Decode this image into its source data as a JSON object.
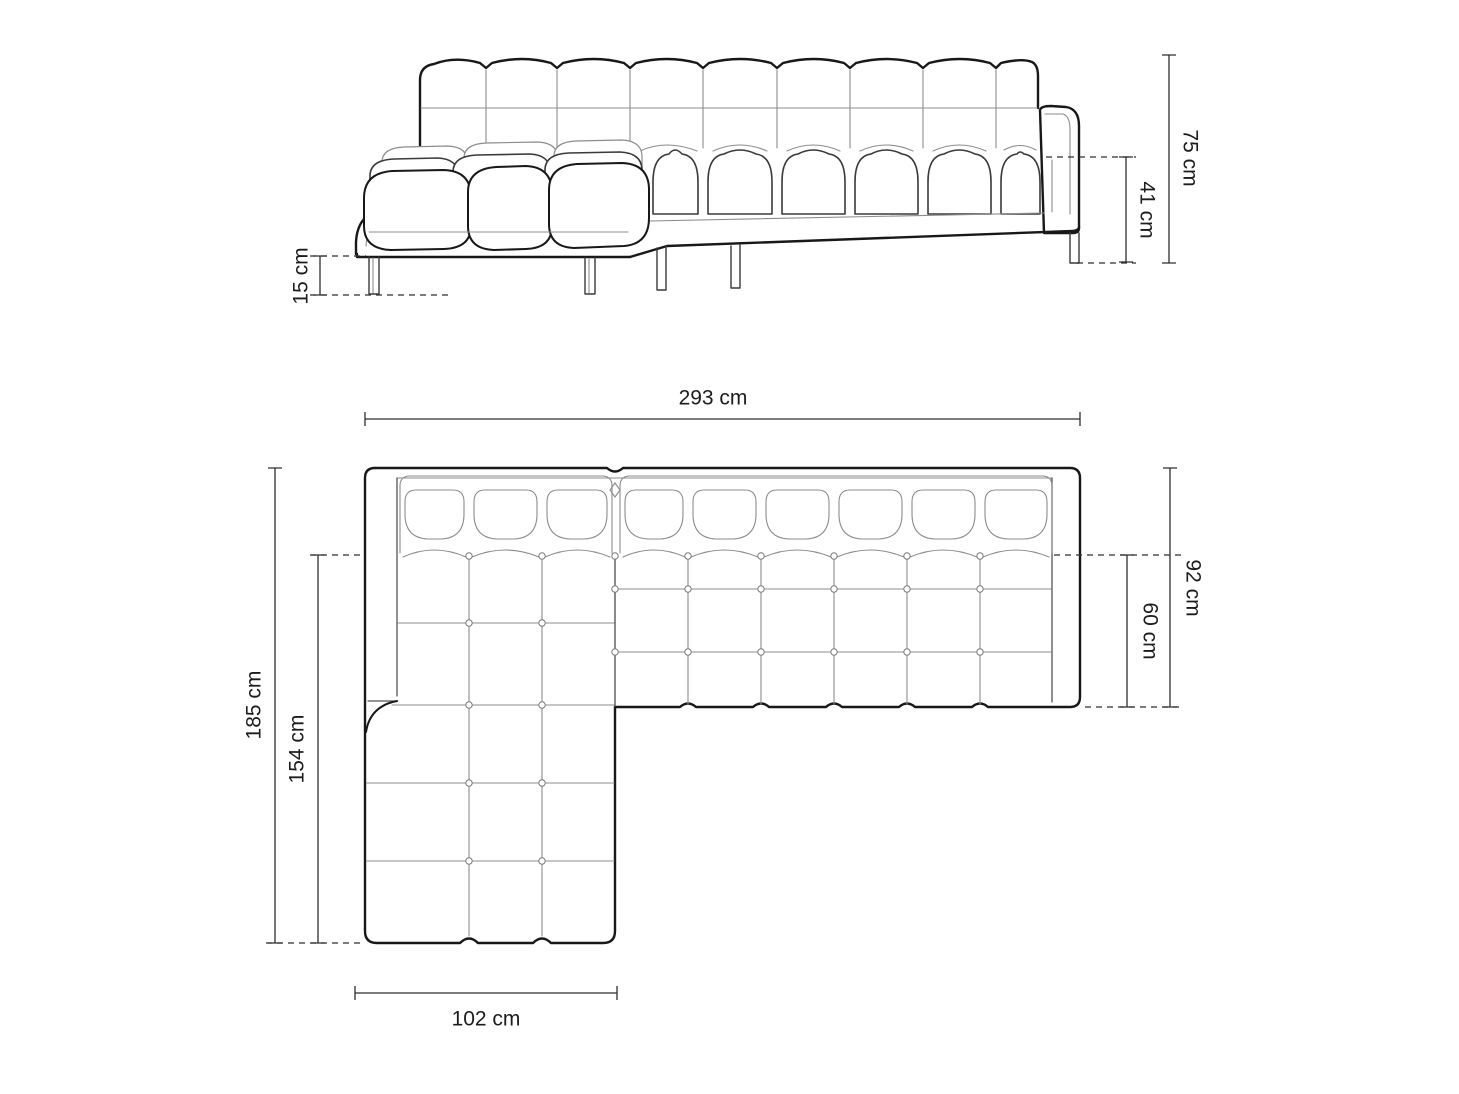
{
  "diagram": {
    "depicts": "corner sofa with left chaise longue, front elevation view and top plan view with dimension lines"
  },
  "colors": {
    "background": "#ffffff",
    "outline": "#181818",
    "seam_line": "#8c8c8c",
    "dimension_line": "#2e2e2e",
    "label_text": "#1c1c1c"
  },
  "front_view": {
    "dimensions": {
      "total_height": {
        "label": "75 cm",
        "value": 75,
        "unit": "cm"
      },
      "seat_height": {
        "label": "41 cm",
        "value": 41,
        "unit": "cm"
      },
      "leg_height": {
        "label": "15 cm",
        "value": 15,
        "unit": "cm"
      }
    }
  },
  "top_view": {
    "dimensions": {
      "total_width": {
        "label": "293 cm",
        "value": 293,
        "unit": "cm"
      },
      "total_depth": {
        "label": "185 cm",
        "value": 185,
        "unit": "cm"
      },
      "chaise_depth": {
        "label": "154 cm",
        "value": 154,
        "unit": "cm"
      },
      "body_depth": {
        "label": "92 cm",
        "value": 92,
        "unit": "cm"
      },
      "seat_depth": {
        "label": "60 cm",
        "value": 60,
        "unit": "cm"
      },
      "chaise_width": {
        "label": "102 cm",
        "value": 102,
        "unit": "cm"
      }
    }
  }
}
